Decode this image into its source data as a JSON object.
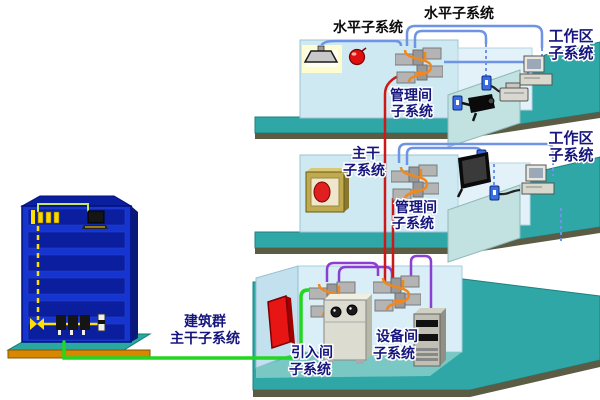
{
  "diagram": {
    "labels": {
      "horizontal_top_left": "水平子系统",
      "horizontal_top_right": "水平子系统",
      "work_area_floor3": {
        "line1": "工作区",
        "line2": "子系统"
      },
      "management_floor3": {
        "line1": "管理间",
        "line2": "子系统"
      },
      "work_area_floor2": {
        "line1": "工作区",
        "line2": "子系统"
      },
      "backbone": {
        "line1": "主干",
        "line2": "子系统"
      },
      "management_floor2": {
        "line1": "管理间",
        "line2": "子系统"
      },
      "campus_backbone": {
        "line1": "建筑群",
        "line2": "主干子系统"
      },
      "entrance": {
        "line1": "引入间",
        "line2": "子系统"
      },
      "equipment_room": {
        "line1": "设备间",
        "line2": "子系统"
      }
    },
    "colors": {
      "floor_teal": "#2fa7a7",
      "room_floor_teal": "#79c8c4",
      "wall_light_blue": "#cfe9f2",
      "wall_lighter_blue": "#e2f2f8",
      "partition_teal": "#c2e2e2",
      "slab_edge_olive": "#5c5c44",
      "building_blue": "#1634cf",
      "building_interior_blue": "#0b1f9e",
      "platform_orange": "#d88800",
      "cable_green": "#22d622",
      "cable_blue": "#6f94e6",
      "cable_red": "#cc1818",
      "cable_purple": "#8a3fd0",
      "cable_orange": "#ef8820",
      "cable_yellow": "#ffe000",
      "label_navy": "#15157d",
      "label_black": "#0a0a0a",
      "entrance_box_red": "#e81515"
    },
    "icons": [
      "ceiling-lamp-icon",
      "smoke-detector-icon",
      "patch-panel-icon",
      "camera-icon",
      "wall-outlet-icon",
      "desktop-computer-icon",
      "printer-icon",
      "wall-tv-icon",
      "fire-cabinet-icon",
      "entrance-terminal-icon",
      "pbx-cabinet-icon",
      "server-rack-icon",
      "office-building-icon"
    ]
  }
}
